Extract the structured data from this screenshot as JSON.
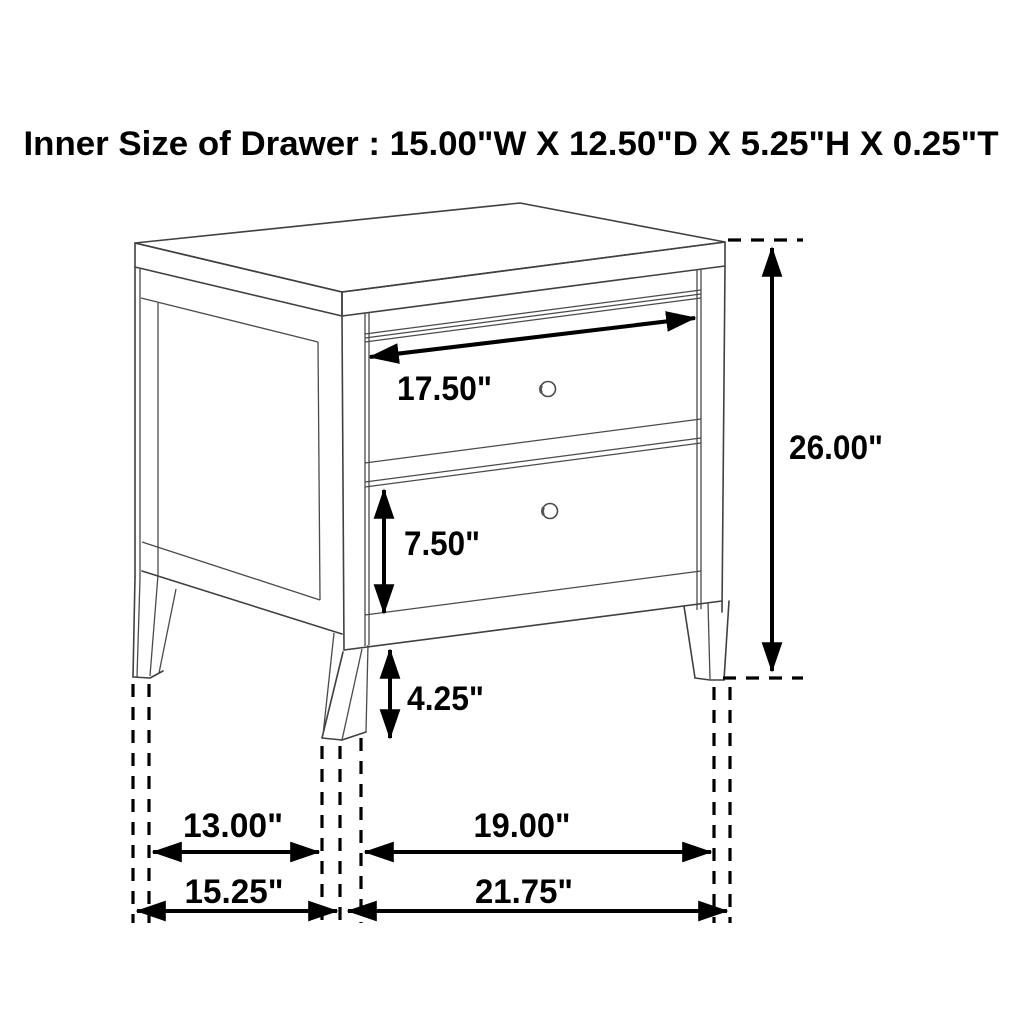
{
  "title": "Inner Size of Drawer : 15.00\"W X 12.50\"D X 5.25\"H X 0.25\"T",
  "diagram": {
    "type": "furniture-dimension-diagram",
    "subject": "two-drawer nightstand isometric line drawing",
    "labels": {
      "drawer_face_width": "17.50\"",
      "lower_drawer_height": "7.50\"",
      "leg_height": "4.25\"",
      "overall_height": "26.00\"",
      "side_leg_spacing": "13.00\"",
      "front_leg_spacing": "19.00\"",
      "overall_depth": "15.25\"",
      "overall_width": "21.75\""
    },
    "colors": {
      "background": "#ffffff",
      "furniture_line": "#404040",
      "annotation": "#000000"
    }
  }
}
